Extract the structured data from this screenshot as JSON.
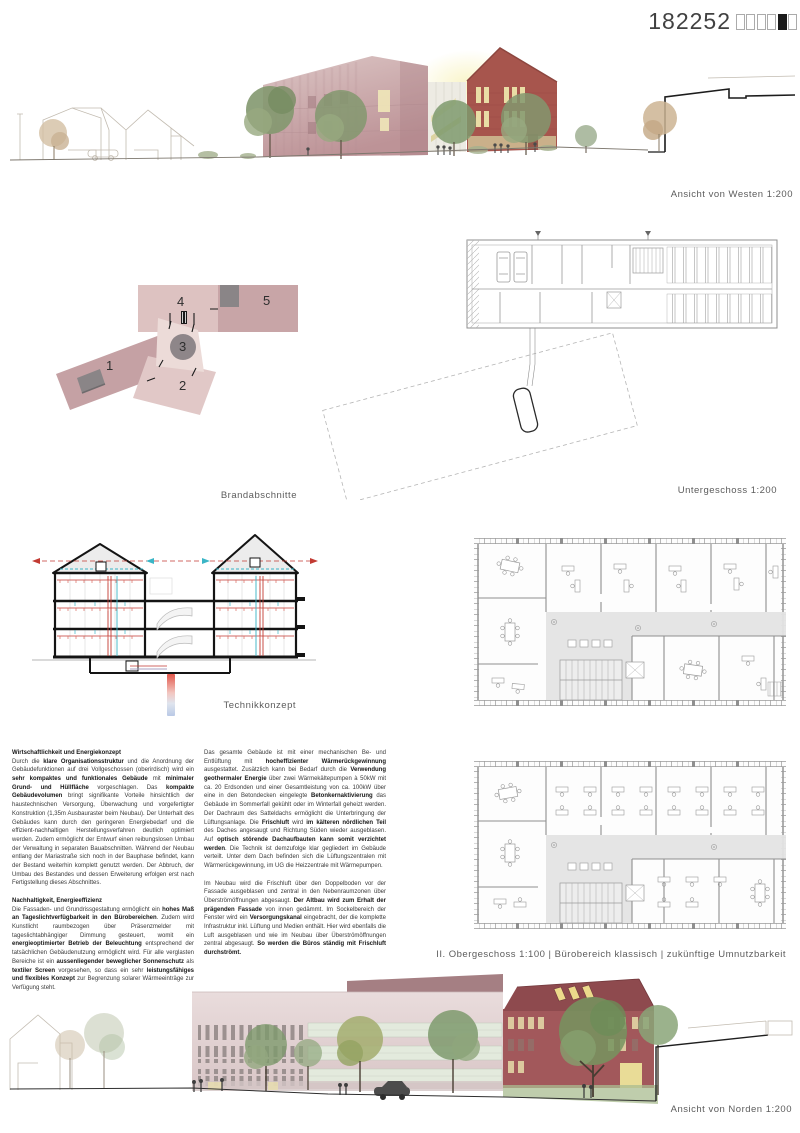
{
  "header": {
    "entry_number": "182252",
    "boxes": [
      "o",
      "o",
      "o",
      "o",
      "x",
      "o"
    ]
  },
  "captions": {
    "west": "Ansicht von Westen 1:200",
    "untergeschoss": "Untergeschoss 1:200",
    "brandabschnitte": "Brandabschnitte",
    "technik": "Technikkonzept",
    "obergeschoss": "II. Obergeschoss 1:100 | Bürobereich klassisch | zukünftige Umnutzbarkeit",
    "nord": "Ansicht von Norden 1:200"
  },
  "brand": {
    "labels": [
      "1",
      "2",
      "3",
      "4",
      "5"
    ]
  },
  "columns": [
    {
      "blocks": [
        {
          "heading": "Wirtschaftlichkeit und Energiekonzept",
          "segments": [
            {
              "t": "Durch die "
            },
            {
              "t": "klare Organisationsstruktur",
              "b": 1
            },
            {
              "t": " und die Anordnung der Gebäudefunktionen auf drei Vollgeschossen (oberirdisch) wird ein "
            },
            {
              "t": "sehr kompaktes und funktionales Gebäude",
              "b": 1
            },
            {
              "t": " mit "
            },
            {
              "t": "minimaler Grund- und Hüllfläche",
              "b": 1
            },
            {
              "t": " vorgeschlagen. Das "
            },
            {
              "t": "kompakte Gebäudevolumen",
              "b": 1
            },
            {
              "t": " bringt signifikante Vorteile hinsichtlich der haustechnischen Versorgung, Überwachung und vorgefertigter Konstruktion (1,35m Ausbauraster beim Neubau). Der Unterhalt des Gebäudes kann durch den geringeren Energiebedarf und die effizient-nachhaltigen Herstellungsverfahren deutlich optimiert werden. Zudem ermöglicht der Entwurf einen reibungslosen Umbau der Verwaltung in separaten Bauabschnitten. Während der Neubau entlang der Mariastraße sich noch in der Bauphase befindet, kann der Bestand weiterhin komplett genutzt werden. Der Abbruch, der Umbau des Bestandes und dessen Erweiterung erfolgen erst nach Fertigstellung dieses Abschnittes."
            }
          ]
        },
        {
          "heading": "Nachhaltigkeit, Energieeffizienz",
          "segments": [
            {
              "t": "Die Fassaden- und Grundrissgestaltung ermöglicht ein "
            },
            {
              "t": "hohes Maß an Tageslichtverfügbarkeit in den Bürobereichen",
              "b": 1
            },
            {
              "t": ". Zudem wird Kunstlicht raumbezogen über Präsenzmelder mit tageslichtabhängiger Dimmung gesteuert, womit ein "
            },
            {
              "t": "energieoptimierter Betrieb der Beleuchtung",
              "b": 1
            },
            {
              "t": " entsprechend der tatsächlichen Gebäudenutzung ermöglicht wird. Für alle verglasten Bereiche ist ein "
            },
            {
              "t": "aussenliegender beweglicher Sonnenschutz",
              "b": 1
            },
            {
              "t": " als "
            },
            {
              "t": "textiler Screen",
              "b": 1
            },
            {
              "t": " vorgesehen, so dass ein sehr "
            },
            {
              "t": "leistungsfähiges und flexibles Konzept",
              "b": 1
            },
            {
              "t": " zur Begrenzung solarer Wärmeeinträge zur Verfügung steht."
            }
          ]
        }
      ]
    },
    {
      "blocks": [
        {
          "heading": "",
          "segments": [
            {
              "t": "Das gesamte Gebäude ist mit einer mechanischen Be- und Entlüftung mit "
            },
            {
              "t": "hocheffizienter Wärmerückgewinnung",
              "b": 1
            },
            {
              "t": " ausgestattet. Zusätzlich kann bei Bedarf durch die "
            },
            {
              "t": "Verwendung geothermaler Energie",
              "b": 1
            },
            {
              "t": " über zwei Wärmekältepumpen à 50kW mit ca. 20 Erdsonden und einer Gesamtleistung von ca. 100kW über eine in den Betondecken eingelegte "
            },
            {
              "t": "Betonkernaktivierung",
              "b": 1
            },
            {
              "t": " das Gebäude im Sommerfall gekühlt oder im Winterfall geheizt werden. Der Dachraum des Satteldachs ermöglicht die Unterbringung der Lüftungsanlage. Die "
            },
            {
              "t": "Frischluft",
              "b": 1
            },
            {
              "t": " wird "
            },
            {
              "t": "im kälteren nördlichen Teil",
              "b": 1
            },
            {
              "t": " des Daches angesaugt und Richtung Süden wieder ausgeblasen. Auf "
            },
            {
              "t": "optisch störende Dachaufbauten kann somit verzichtet werden",
              "b": 1
            },
            {
              "t": ". Die Technik ist demzufolge klar gegliedert im Gebäude verteilt. Unter dem Dach befinden sich die Lüftungszentralen mit Wärmerückgewinnung, im UG die Heizzentrale mit Wärmepumpen."
            }
          ]
        },
        {
          "heading": "",
          "segments": [
            {
              "t": "Im Neubau wird die Frischluft über den Doppelboden vor der Fassade ausgeblasen und zentral in den Nebenraumzonen über Überströmöffnungen abgesaugt. "
            },
            {
              "t": "Der Altbau wird zum Erhalt der prägenden Fassade",
              "b": 1
            },
            {
              "t": " von innen gedämmt. Im Sockelbereich der Fenster wird ein "
            },
            {
              "t": "Versorgungskanal",
              "b": 1
            },
            {
              "t": " eingebracht, der die komplette Infrastruktur inkl. Lüftung und Medien enthält. Hier wird ebenfalls die Luft ausgeblasen und wie im Neubau über Überströmöffnungen zentral abgesaugt. "
            },
            {
              "t": "So werden die Büros ständig mit Frischluft durchströmt.",
              "b": 1
            }
          ]
        }
      ]
    }
  ],
  "colors": {
    "mauve_building": "#c2989b",
    "brick_red": "#a8544c",
    "pale_pink_facade": "#e2d2d3",
    "glass_green": "#e3eadd",
    "tree_green": "#7e9a6d",
    "hvac_red": "#c23a32",
    "hvac_cyan": "#3ab5c6",
    "section_gray": "#8e8689",
    "corridor_gray": "#e4e4e4",
    "caption_gray": "#5c5c5c"
  }
}
